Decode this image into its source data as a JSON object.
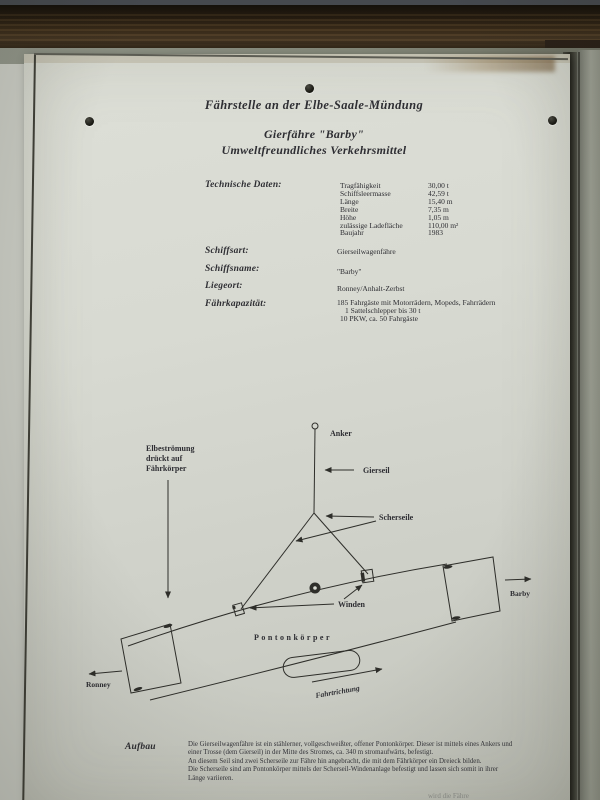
{
  "photo": {
    "colors": {
      "wall": "#c7c9c1",
      "board": "#d8dad2",
      "beam_wood": "#3e2f1c",
      "metal_strip": "#45494e",
      "right_strip": "#8f9286",
      "ink": "#2e2e33"
    }
  },
  "sign": {
    "header": {
      "title": "Fährstelle an der Elbe-Saale-Mündung",
      "subtitle1": "Gierfähre \"Barby\"",
      "subtitle2": "Umweltfreundliches Verkehrsmittel"
    },
    "technical": {
      "label": "Technische Daten:",
      "rows": [
        {
          "name": "Tragfähigkeit",
          "value": "30,00 t"
        },
        {
          "name": "Schiffsleermasse",
          "value": "42,59 t"
        },
        {
          "name": "Länge",
          "value": "15,40 m"
        },
        {
          "name": "Breite",
          "value": "7,35 m"
        },
        {
          "name": "Höhe",
          "value": "1,05 m"
        },
        {
          "name": "zulässige Ladefläche",
          "value": "110,00 m²"
        },
        {
          "name": "Baujahr",
          "value": "1983"
        }
      ]
    },
    "fields": [
      {
        "label": "Schiffsart:",
        "value": "Gierseilwagenfähre"
      },
      {
        "label": "Schiffsname:",
        "value": "\"Barby\""
      },
      {
        "label": "Liegeort:",
        "value": "Ronney/Anhalt-Zerbst"
      },
      {
        "label": "Fährkapazität:",
        "value": "185 Fahrgäste mit Motorrädern, Mopeds, Fahrrädern",
        "value2": "1 Sattelschlepper bis 30 t",
        "value3": "10 PKW, ca. 50 Fahrgäste"
      }
    ],
    "diagram": {
      "anker": "Anker",
      "gierseil": "Gierseil",
      "scherseile": "Scherseile",
      "winden": "Winden",
      "pontonkoerper": "Pontonkörper",
      "stroemung1": "Elbeströmung",
      "stroemung2": "drückt auf",
      "stroemung3": "Fährkörper",
      "ronney": "Ronney",
      "barby": "Barby",
      "fahrtrichtung": "Fahrtrichtung"
    },
    "aufbau": {
      "label": "Aufbau",
      "lines": [
        "Die Gierseilwagenfähre ist ein stählerner, vollgeschweißter, offener Pontonkörper. Dieser ist mittels eines Ankers und",
        "einer Trosse (dem Gierseil) in der Mitte des Stromes, ca. 340 m stromaufwärts, befestigt.",
        "An diesem Seil sind zwei Scherseile zur Fähre hin angebracht, die mit dem Fährkörper ein Dreieck bilden.",
        "Die Scherseile sind am Pontonkörper mittels der Scherseil-Windenanlage befestigt und lassen sich somit in ihrer",
        "Länge variieren."
      ],
      "cutoff_fragment": "wird die Fähre"
    }
  }
}
